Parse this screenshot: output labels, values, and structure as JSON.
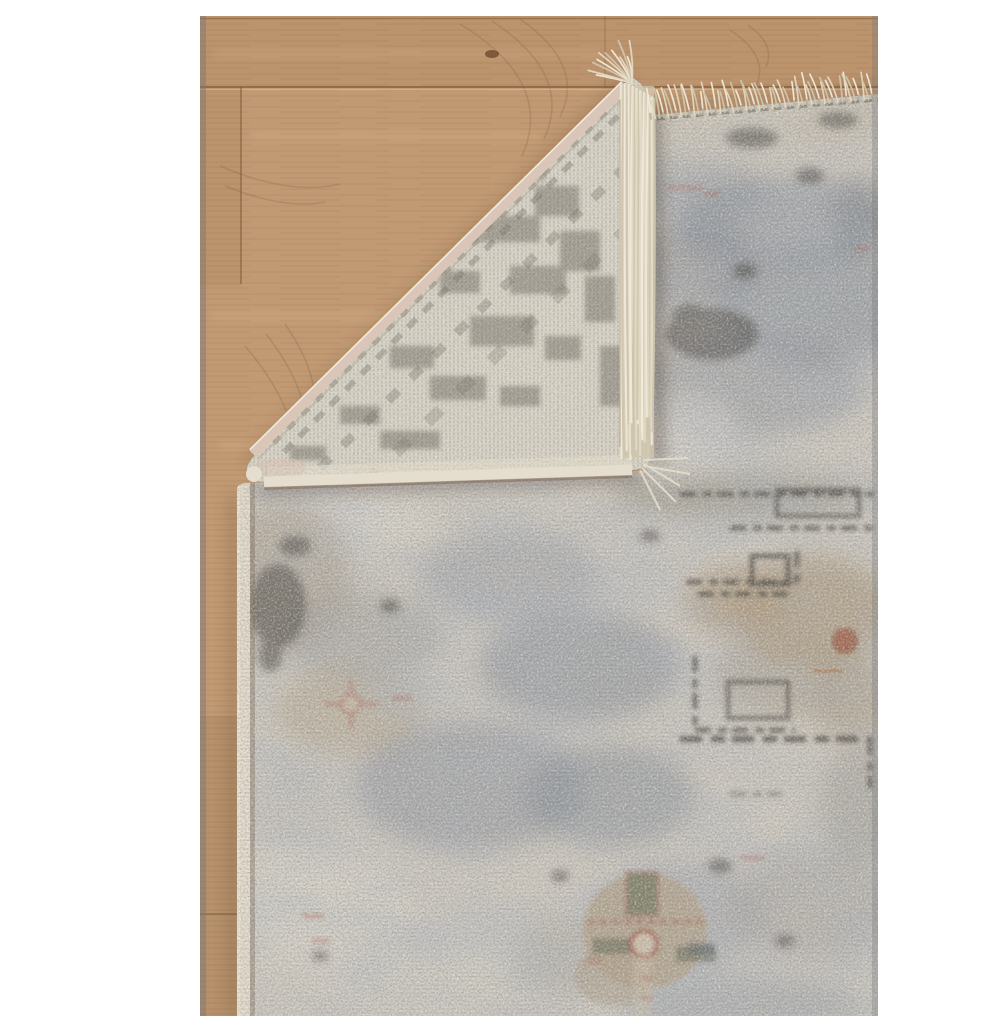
{
  "scene": {
    "alt": "Product photo of a distressed grey and beige traditional area rug with its top-left corner folded over, revealing the woven cream back and tasseled fringe, lying on a light oak wood floor",
    "subject": "area rug with folded corner",
    "elements": [
      "white margin",
      "oak plank floor",
      "rug pile front",
      "folded corner showing woven back",
      "cream fringe tassels",
      "serged cloth edges"
    ]
  },
  "palette": {
    "background": "#ffffff",
    "wood_base": "#c19a74",
    "wood_shade": "#a07a55",
    "wood_seam": "#7a5838",
    "wood_streak": "#e6c196",
    "photo_edge": "#9a9a9a",
    "pile_base": "#cfcac1",
    "pile_light": "#e0ddd5",
    "pile_silver": "#d7d3ca",
    "pile_taupe": "#b6a48a",
    "pile_blue": "#8b93a0",
    "pile_slate": "#6a7380",
    "pile_charcoal": "#413e3a",
    "pile_dark": "#3b3935",
    "back_base": "#ded9cc",
    "back_grid": "#827e72",
    "back_pattern": "#807d72",
    "back_dark": "#6f6c62",
    "binding": "#d9c6b8",
    "serge": "#e5ddcd",
    "fringe_light": "#f0eadb",
    "fringe_mid": "#e2d9c4",
    "fringe_dark": "#cfc5ae",
    "accent_rust": "#a3604b",
    "accent_red": "#b26355",
    "accent_green": "#5c664d",
    "accent_navy": "#5a6472",
    "shadow": "#5e452b"
  }
}
